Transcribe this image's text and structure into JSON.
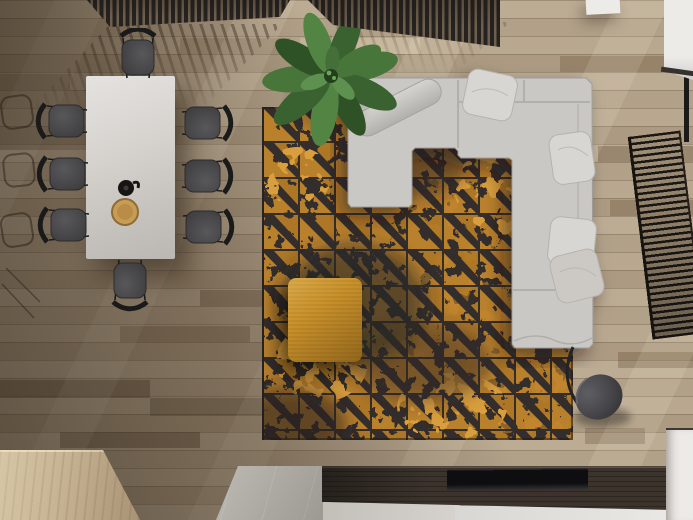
{
  "scene": {
    "description": "top-down 3d render of a living room and dining area",
    "view": "bird's-eye",
    "canvas": {
      "width": 693,
      "height": 520
    }
  },
  "palette": {
    "floor_light": "#bcac94",
    "floor_dark": "#6a5a49",
    "rug_base": "#332d2b",
    "rug_gold": "#c6892f",
    "rug_gold_light": "#d99e3e",
    "sofa_fabric": "#cac8c4",
    "pillow": "#d8d6d2",
    "ottoman": "#c8912c",
    "plant_green": "#47753a",
    "plant_green_dark": "#2e5226",
    "table_marble": "#d6d3cf",
    "chair_seat": "#4a494b",
    "chair_frame": "#1a1a1a",
    "console_wood": "#3b332c",
    "tv_black": "#0e0e10",
    "stone_slab": "#b3aea7",
    "wood_block": "#c6b392",
    "white_furniture": "#edebe8",
    "lamp_shade": "#4a4a4d",
    "slat_dark": "#262220",
    "bowl_wood": "#c79c57",
    "teapot_black": "#171513",
    "dark_edge": "#35312d"
  },
  "inventory": {
    "dining_chairs": 8,
    "sofa_pillows": 4,
    "plant_leaves": 10,
    "tabletop_items": [
      "black teapot",
      "wooden bowl"
    ],
    "objects": [
      "dining-table",
      "dining-chairs",
      "slatted-screen",
      "banana-plant",
      "area-rug",
      "sectional-sofa",
      "throw-pillows",
      "ottoman",
      "floor-lamp",
      "media-console",
      "tv-panel",
      "stone-slab",
      "wood-block",
      "window-blinds",
      "white-cabinets"
    ]
  }
}
